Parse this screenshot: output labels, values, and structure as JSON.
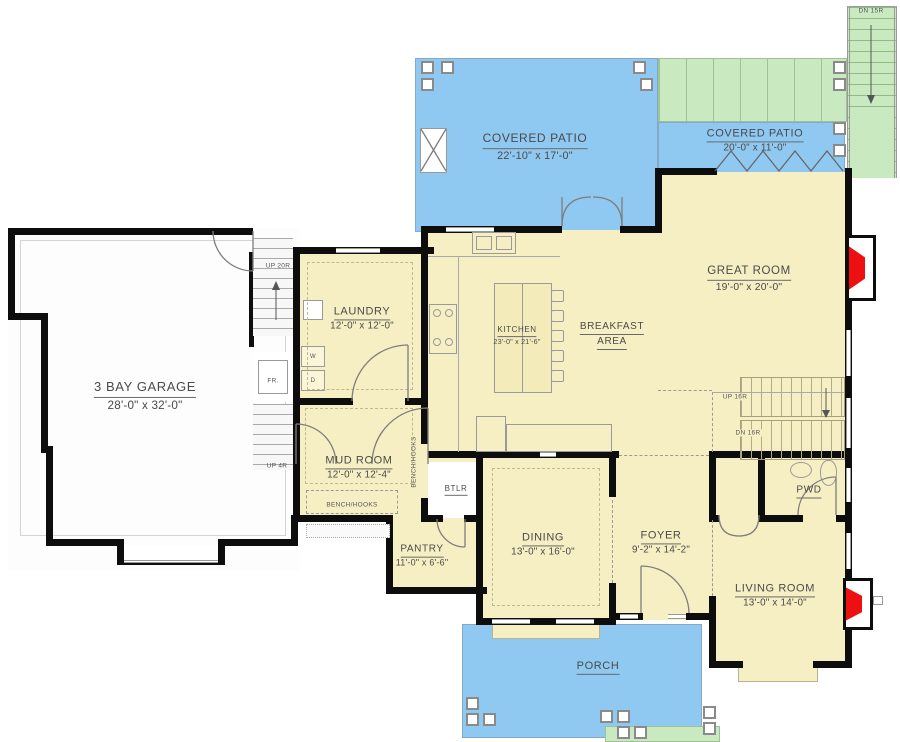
{
  "colors": {
    "floor": "#f6efc3",
    "patio": "#8fc8f0",
    "deck_green": "#c9eac1",
    "wall": "#0d0d0d",
    "fireplace": "#ee1010"
  },
  "rooms": {
    "garage": {
      "name": "3 BAY GARAGE",
      "dims": "28'-0\" x 32'-0\""
    },
    "laundry": {
      "name": "LAUNDRY",
      "dims": "12'-0\" x 12'-0\""
    },
    "mud_room": {
      "name": "MUD ROOM",
      "dims": "12'-0\" x 12'-4\""
    },
    "kitchen": {
      "name": "KITCHEN",
      "dims": "23'-0\" x 21'-6\""
    },
    "breakfast": {
      "name_line1": "BREAKFAST",
      "name_line2": "AREA"
    },
    "great_room": {
      "name": "GREAT ROOM",
      "dims": "19'-0\" x 20'-0\""
    },
    "covered_patio_main": {
      "name": "COVERED PATIO",
      "dims": "22'-10\" x 17'-0\""
    },
    "covered_patio_side": {
      "name": "COVERED PATIO",
      "dims": "20'-0\" x 11'-0\""
    },
    "dining": {
      "name": "DINING",
      "dims": "13'-0\" x 16'-0\""
    },
    "foyer": {
      "name": "FOYER",
      "dims": "9'-2\" x 14'-2\""
    },
    "pantry": {
      "name": "PANTRY",
      "dims": "11'-0\" x 6'-6\""
    },
    "butler": {
      "name": "BTLR"
    },
    "powder": {
      "name": "PWD"
    },
    "living_room": {
      "name": "LIVING ROOM",
      "dims": "13'-0\" x 14'-0\""
    },
    "porch": {
      "name": "PORCH"
    }
  },
  "stairs": {
    "garage_up": "UP 20R",
    "garage_up_small": "UP 4R",
    "main_up": "UP 16R",
    "main_dn": "DN 16R",
    "deck_dn": "DN 15R"
  },
  "fixtures": {
    "washer": "W",
    "dryer": "D",
    "freezer": "FR.",
    "bench_hooks_bottom": "BENCH/HOOKS",
    "bench_hooks_side": "BENCH/HOOKS"
  }
}
